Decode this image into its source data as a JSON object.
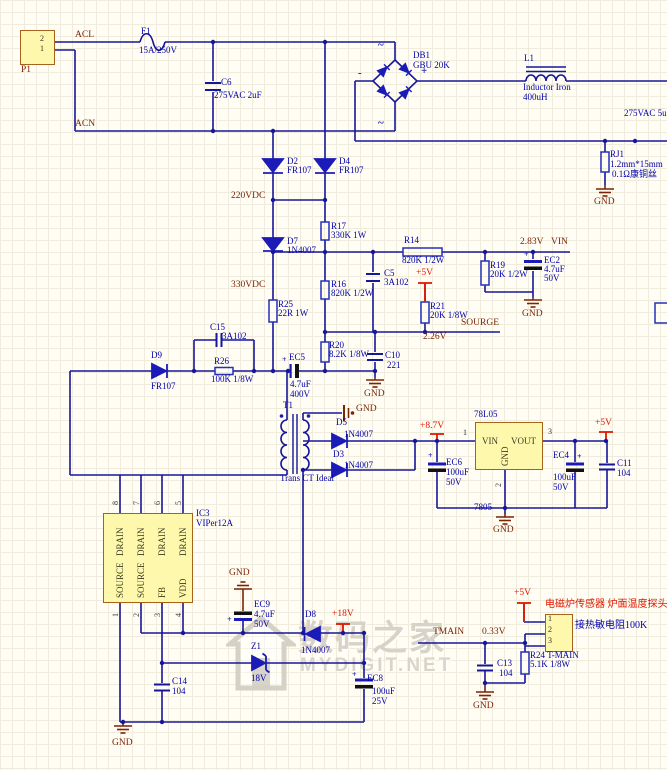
{
  "colors": {
    "wire": "#16169a",
    "label": "#0202a8",
    "net": "#7b2505",
    "power": "#e01800",
    "box_fill": "#fdf8ac",
    "box_border": "#a5631c",
    "diode": "#1b1bb8",
    "plate_black": "#111111"
  },
  "connectors": {
    "p1": {
      "ref": "P1",
      "pin_top": "2",
      "pin_bottom": "1"
    },
    "sensor": {
      "pin1": "1",
      "pin2": "2",
      "pin3": "3",
      "title": "电磁炉传感器 炉面温度探头",
      "note": "接热敏电阻100K"
    }
  },
  "nets": {
    "acl": "ACL",
    "acn": "ACN",
    "v220": "220VDC",
    "v330": "330VDC",
    "vin": "VIN",
    "v283": "2.83V",
    "sourge": "SOURGE",
    "v226": "2.26V",
    "v5": "+5V",
    "v87": "+8.7V",
    "v18": "+18V",
    "tmain": "TMAIN",
    "v033": "0.33V",
    "gnd": "GND",
    "vac_right": "275VAC 5u"
  },
  "bridge_marks": {
    "ac": "~",
    "plus": "+",
    "minus": "-"
  },
  "parts": {
    "plus": "+",
    "f1": {
      "ref": "F1",
      "value": "15A/250V"
    },
    "c6": {
      "ref": "C6",
      "value": "275VAC 2uF"
    },
    "db1": {
      "ref": "DB1",
      "value": "GBU 20K"
    },
    "l1": {
      "ref": "L1",
      "value": "Inductor Iron",
      "value2": "400uH"
    },
    "rj1": {
      "ref": "RJ1",
      "value": "1.2mm*15mm",
      "value2": "0.1Ω康铜丝"
    },
    "d2": {
      "ref": "D2",
      "value": "FR107"
    },
    "d4": {
      "ref": "D4",
      "value": "FR107"
    },
    "d7": {
      "ref": "D7",
      "value": "1N4007"
    },
    "d9": {
      "ref": "D9",
      "value": "FR107"
    },
    "d5": {
      "ref": "D5",
      "value": "1N4007"
    },
    "d3": {
      "ref": "D3",
      "value": "1N4007"
    },
    "d8": {
      "ref": "D8",
      "value": "1N4007"
    },
    "z1": {
      "ref": "Z1",
      "value": "18V"
    },
    "r14": {
      "ref": "R14",
      "value": "820K 1/2W"
    },
    "r16": {
      "ref": "R16",
      "value": "820K 1/2W"
    },
    "r17": {
      "ref": "R17",
      "value": "330K 1W"
    },
    "r19": {
      "ref": "R19",
      "value": "20K 1/2W"
    },
    "r20": {
      "ref": "R20",
      "value": "8.2K 1/8W"
    },
    "r21": {
      "ref": "R21",
      "value": "20K 1/8W"
    },
    "r24": {
      "ref": "R24 T-MAIN",
      "value": "5.1K 1/8W"
    },
    "r25": {
      "ref": "R25",
      "value": "22R 1W"
    },
    "r26": {
      "ref": "R26",
      "value": "100K 1/8W"
    },
    "c5": {
      "ref": "C5",
      "value": "3A102"
    },
    "c10": {
      "ref": "C10",
      "value": "221"
    },
    "c11": {
      "ref": "C11",
      "value": "104"
    },
    "c13": {
      "ref": "C13",
      "value": "104"
    },
    "c14": {
      "ref": "C14",
      "value": "104"
    },
    "c15": {
      "ref": "C15",
      "value": "3A102"
    },
    "ec2": {
      "ref": "EC2",
      "value": "4.7uF",
      "value2": "50V"
    },
    "ec4": {
      "ref": "EC4",
      "value": "100uF",
      "value2": "50V"
    },
    "ec5": {
      "ref": "EC5",
      "value": "4.7uF",
      "value2": "400V"
    },
    "ec6": {
      "ref": "EC6",
      "value": "100uF",
      "value2": "50V"
    },
    "ec8": {
      "ref": "EC8",
      "value": "100uF",
      "value2": "25V"
    },
    "ec9": {
      "ref": "EC9",
      "value": "4.7uF",
      "value2": "50V"
    },
    "t1": {
      "ref": "T1",
      "value": "Trans CT Ideal"
    },
    "u78": {
      "ref": "78L05",
      "sub": "7805",
      "pin_vin": "VIN",
      "pin_vout": "VOUT",
      "pin_gnd": "GND",
      "n1": "1",
      "n2": "2",
      "n3": "3"
    },
    "ic3": {
      "ref": "IC3",
      "value": "VIPer12A",
      "top_numbers": [
        "8",
        "7",
        "6",
        "5"
      ],
      "bottom_numbers": [
        "1",
        "2",
        "3",
        "4"
      ],
      "top_names": [
        "DRAIN",
        "DRAIN",
        "DRAIN",
        "DRAIN"
      ],
      "bottom_names": [
        "SOURCE",
        "SOURCE",
        "FB",
        "VDD"
      ]
    }
  },
  "watermark": {
    "cn": "数码之家",
    "en": "MYDIGIT.NET"
  }
}
